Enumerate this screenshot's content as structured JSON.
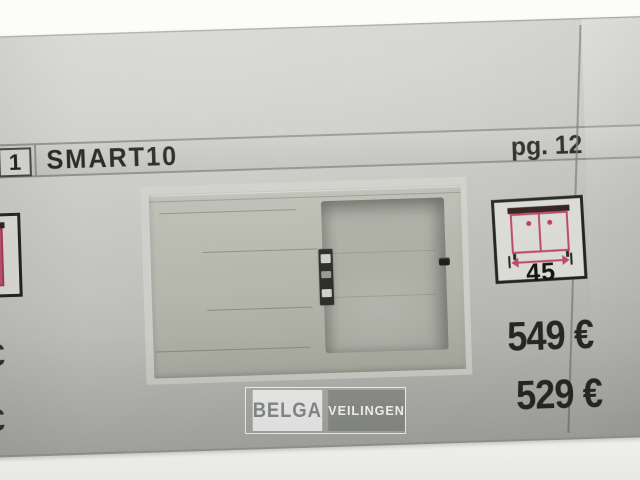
{
  "header": {
    "index": "1",
    "title": "SMART10",
    "page_label": "pg. 12"
  },
  "size_icon": {
    "name": "cabinet-width-icon",
    "width_value": "45"
  },
  "prices": {
    "primary": "549 €",
    "secondary": "529 €"
  },
  "adjacent_column": {
    "euro_partial_top": "€",
    "euro_partial_bottom": "€"
  },
  "watermark": {
    "brand": "BELGA",
    "suffix": "VEILINGEN"
  },
  "colors": {
    "accent_pink": "#bc4a66",
    "page_gray": "#c3c4c0",
    "sink_beige": "#b4b5ab",
    "text_dark": "#222220"
  }
}
